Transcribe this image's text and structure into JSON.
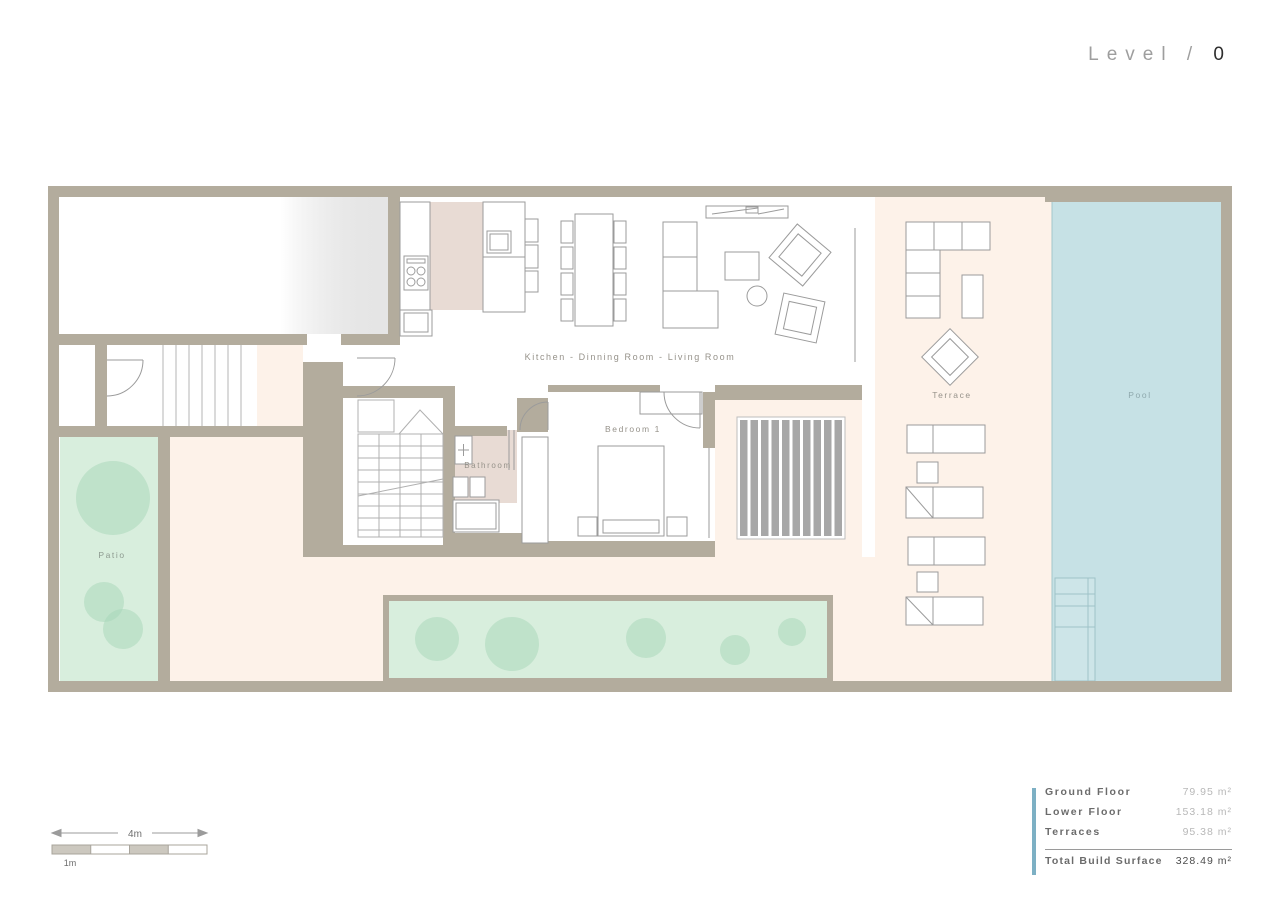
{
  "title": {
    "prefix": "Level /",
    "number": "0"
  },
  "plan": {
    "labels": {
      "kitchen_living": "Kitchen - Dinning Room - Living Room",
      "bedroom": "Bedroom 1",
      "bathroom": "Bathroom",
      "terrace": "Terrace",
      "pool": "Pool",
      "patio": "Patio"
    },
    "colors": {
      "wall": "#b3ac9d",
      "interior_floor": "#ffffff",
      "tiled_floor_pink": "#e8dbd4",
      "terrace_cream": "#fdf2e9",
      "pool_blue": "#c6e1e5",
      "garden_green": "#d8eedd",
      "tree_green": "#a5d6b8",
      "deck_stripe": "#a7a7a7",
      "line": "#9b9b9b"
    }
  },
  "scale_bar": {
    "total": "4m",
    "unit": "1m"
  },
  "area_table": {
    "accent_color": "#7db0c4",
    "rows": [
      {
        "label": "Ground Floor",
        "value": "79.95 m²"
      },
      {
        "label": "Lower Floor",
        "value": "153.18 m²"
      },
      {
        "label": "Terraces",
        "value": "95.38 m²"
      }
    ],
    "total": {
      "label": "Total Build Surface",
      "value": "328.49 m²"
    }
  }
}
